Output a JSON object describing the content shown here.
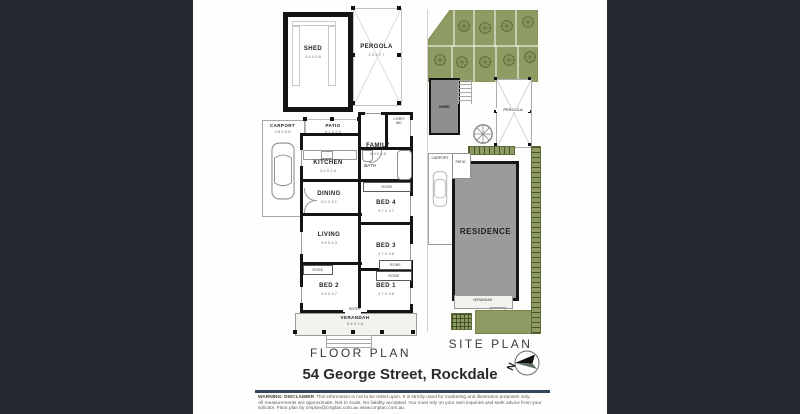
{
  "title": "54 George Street, Rockdale",
  "floor_plan": {
    "caption": "FLOOR PLAN",
    "rooms": {
      "shed": {
        "name": "SHED",
        "dims": "3.4 X 5.8"
      },
      "pergola": {
        "name": "PERGOLA",
        "dims": "2.9 X 7.7"
      },
      "carport": {
        "name": "CARPORT",
        "dims": "2.8 X 5.8"
      },
      "patio": {
        "name": "PATIO",
        "dims": "5.1 X 2.5"
      },
      "kitchen": {
        "name": "KITCHEN",
        "dims": "3.2 X 2.4"
      },
      "family": {
        "name": "FAMILY",
        "dims": "5.9 X 4.8"
      },
      "laundry_wc": {
        "name": "L'DRY/",
        "name2": "WC"
      },
      "bath": {
        "name": "BATH"
      },
      "dining": {
        "name": "DINING",
        "dims": "5.0 X 3.1"
      },
      "bed4": {
        "name": "BED 4",
        "dims": "3.7 X 3.7"
      },
      "living": {
        "name": "LIVING",
        "dims": "3.9 X 4.3"
      },
      "bed3": {
        "name": "BED 3",
        "dims": "3.7 X 3.6"
      },
      "bed2": {
        "name": "BED 2",
        "dims": "3.4 X 3.7"
      },
      "bed1": {
        "name": "BED 1",
        "dims": "3.7 X 3.6"
      },
      "verandah": {
        "name": "VERANDAH",
        "dims": "8.4 X 1.8"
      },
      "robe": "ROBE",
      "entry": "ENTRY"
    }
  },
  "site_plan": {
    "caption": "SITE PLAN",
    "labels": {
      "shed": "SHED",
      "pergola": "PERGOLA",
      "carport": "CARPORT",
      "patio": "PATIO",
      "residence": "RESIDENCE",
      "verandah": "VERANDAH"
    },
    "compass_north": "N"
  },
  "footer": {
    "warning_label": "WARNING: DISCLAIMER",
    "line1": "This information is not to be relied upon. It is strictly used for marketing and illustration purposes only.",
    "line2": "All measurements are approximate. Not to scale. No liability accepted. You must rely on your own inquiries and seek advice from your",
    "line3": "solicitor. Floor plan by cmplan@cmplan.com.au www.cmplan.com.au"
  },
  "colors": {
    "background": "#232831",
    "sheet": "#ffffff",
    "wall": "#141414",
    "garden_green": "#8e9c63",
    "hedge_dark": "#55632f",
    "building_gray": "#9b9b9b",
    "divider_rule": "#33465c"
  }
}
